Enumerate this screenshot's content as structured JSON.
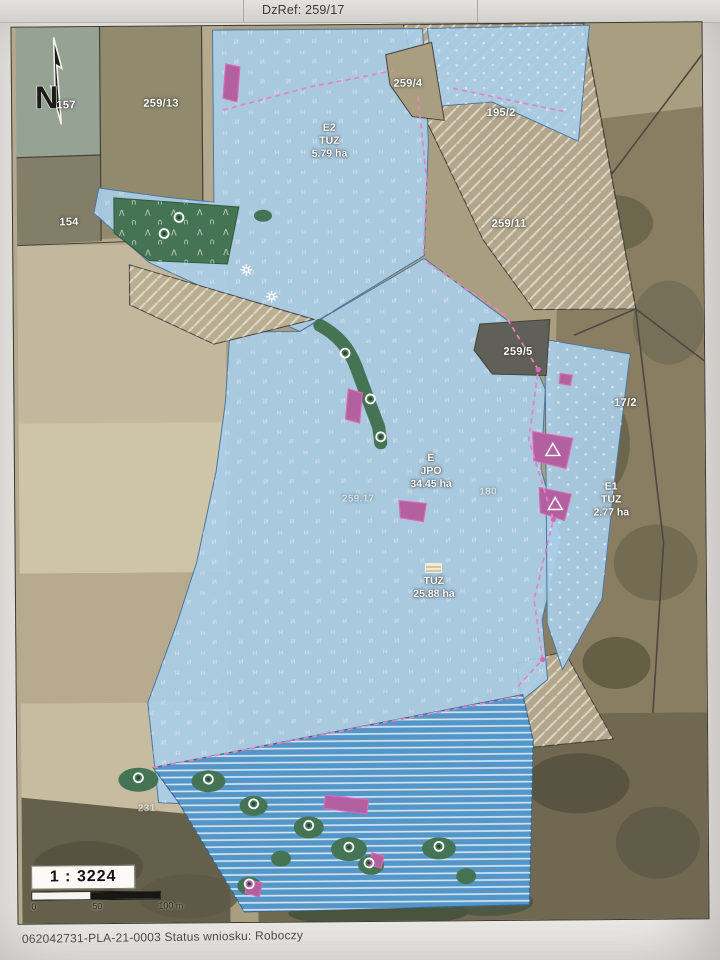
{
  "header": {
    "dzref": "DzRef: 259/17"
  },
  "map": {
    "north_label": "N",
    "labels": {
      "p157": "157",
      "p259_13": "259/13",
      "p154": "154",
      "p259_4": "259/4",
      "p195_2": "195/2",
      "p259_11": "259/11",
      "p259_5": "259/5",
      "p17_2": "17/2",
      "p180": "180",
      "p259_17": "259.17",
      "p231": "231"
    },
    "areas": {
      "e2": {
        "code": "E2",
        "crop": "TUZ",
        "area": "5.79 ha"
      },
      "jpo": {
        "code": "E",
        "crop": "JPO",
        "area": "34.45 ha"
      },
      "tuz": {
        "crop": "TUZ",
        "area": "25.88 ha"
      },
      "e1": {
        "code": "E1",
        "crop": "TUZ",
        "area": "2.77 ha"
      }
    },
    "scalebar": {
      "ratio": "1 : 3224",
      "t0": "0",
      "t50": "50",
      "t100": "100 m"
    }
  },
  "footer": {
    "line": "062042731-PLA-21-0003 Status wniosku: Roboczy"
  },
  "colors": {
    "overlay_blue": "#a7cde8",
    "overlay_blue_striped": "#4f93c8",
    "magenta": "#b05a9c",
    "green": "#3e6f4e",
    "dashed_pink": "#e87ec0",
    "paper": "#efeeeb",
    "header_strip": "#d8d6d2"
  }
}
